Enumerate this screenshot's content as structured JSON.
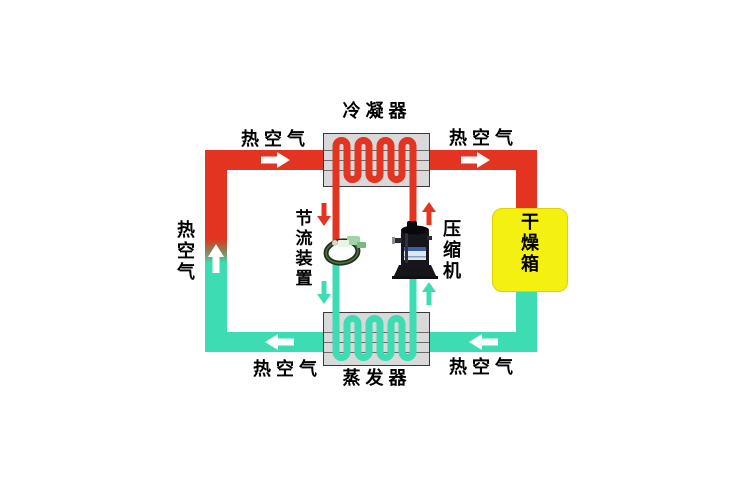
{
  "diagram": {
    "type": "heat-pump-drying-system-schematic",
    "components": {
      "condenser": {
        "label": "冷凝器"
      },
      "evaporator": {
        "label": "蒸发器"
      },
      "compressor": {
        "label": "压缩机"
      },
      "throttle_device": {
        "label": "节流装置"
      },
      "drying_box": {
        "label": "干燥箱"
      }
    },
    "air_labels": {
      "top_left": "热空气",
      "top_right": "热空气",
      "bottom_left": "热空气",
      "bottom_right": "热空气",
      "left_vertical": "热空气"
    },
    "colors": {
      "hot_air_pipe": "#e23420",
      "cool_air_pipe": "#3edcb2",
      "drying_box_fill": "#f4f111",
      "heat_exchanger_fill": "#d9d9d9",
      "arrow": "#ffffff"
    }
  }
}
